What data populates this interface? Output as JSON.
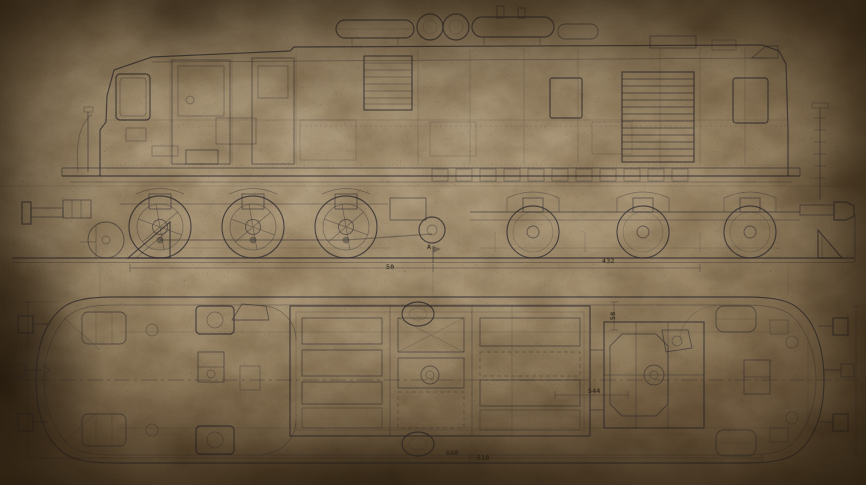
{
  "palette": {
    "paper_base": "#a89272",
    "paper_light": "#b2a082",
    "paper_shadow": "#6b5840",
    "vignette_brown": "#281c0e",
    "ink": "#2a2830",
    "stain": "#6b5132"
  },
  "labels": {
    "section_a": {
      "text": "A"
    },
    "dim_432": {
      "text": "432"
    },
    "dim_50": {
      "text": "50"
    },
    "dim_544": {
      "text": "544"
    },
    "dim_58": {
      "text": "58"
    },
    "dim_680": {
      "text": "680"
    },
    "dim_510": {
      "text": "510"
    }
  }
}
